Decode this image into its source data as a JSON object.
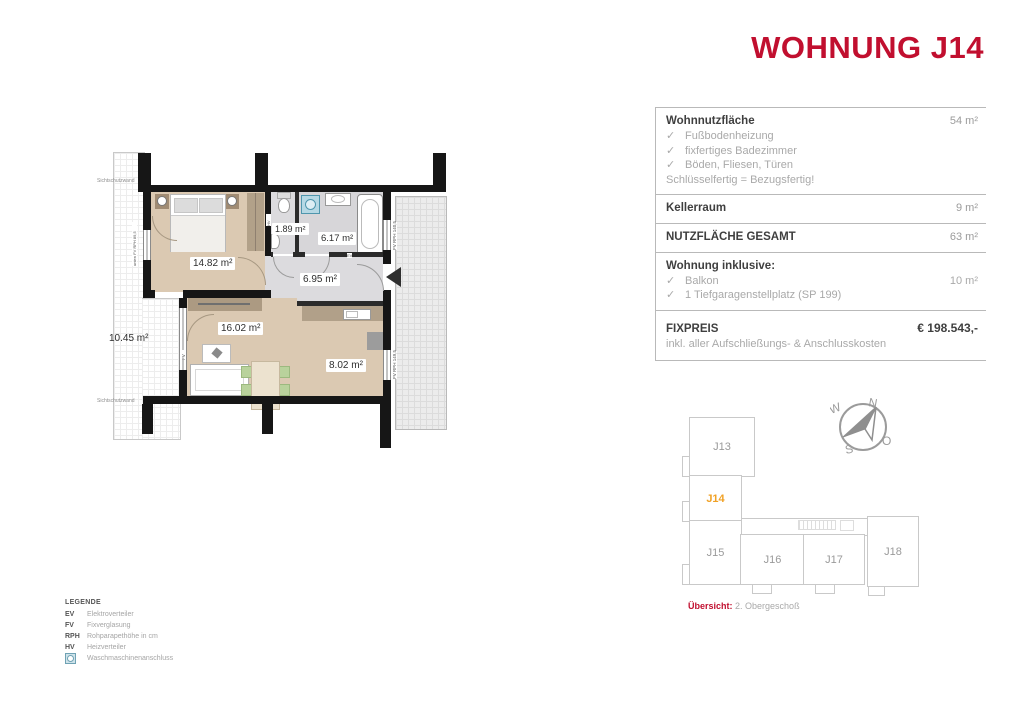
{
  "title": "WOHNUNG J14",
  "info": {
    "check": "✓",
    "wohnnutz_label": "Wohnnutzfläche",
    "wohnnutz_value": "54 m²",
    "wohnnutz_items": [
      "Fußbodenheizung",
      "fixfertiges Badezimmer",
      "Böden, Fliesen, Türen"
    ],
    "wohnnutz_note": "Schlüsselfertig = Bezugsfertig!",
    "keller_label": "Kellerraum",
    "keller_value": "9 m²",
    "gesamt_label": "NUTZFLÄCHE GESAMT",
    "gesamt_value": "63 m²",
    "inklusive_label": "Wohnung inklusive:",
    "inklusive_items": [
      {
        "text": "Balkon",
        "value": "10 m²"
      },
      {
        "text": "1 Tiefgaragenstellplatz (SP 199)",
        "value": ""
      }
    ],
    "fixpreis_label": "FIXPREIS",
    "fixpreis_value": "€ 198.543,-",
    "fixpreis_note": "inkl. aller Aufschließungs- & Anschlusskosten"
  },
  "plan": {
    "rooms": {
      "bedroom": "14.82 m²",
      "wc": "1.89 m²",
      "bath": "6.17 m²",
      "hall": "6.95 m²",
      "living": "16.02 m²",
      "kitchen": "8.02 m²",
      "balcony": "10.45 m²"
    },
    "annotations": {
      "privacy_top": "Sichtschutzwand",
      "privacy_bottom": "Sichtschutzwand",
      "bedroom_window": "unten FV RPH 89,5",
      "hv": "HV",
      "ev": "EV",
      "bath_window": "FV RPH 140,5",
      "kitchen_window": "FV RPH 149,5",
      "living_window": "FV"
    }
  },
  "legend": {
    "title": "LEGENDE",
    "rows": [
      {
        "key": "EV",
        "label": "Elektroverteiler"
      },
      {
        "key": "FV",
        "label": "Fixverglasung"
      },
      {
        "key": "RPH",
        "label": "Rohparapethöhe in cm"
      },
      {
        "key": "HV",
        "label": "Heizverteiler"
      }
    ],
    "wm_label": "Waschmaschinenanschluss"
  },
  "overview": {
    "units": [
      {
        "id": "J13"
      },
      {
        "id": "J14"
      },
      {
        "id": "J15"
      },
      {
        "id": "J16"
      },
      {
        "id": "J17"
      },
      {
        "id": "J18"
      }
    ],
    "highlighted": "J14",
    "caption_label": "Übersicht:",
    "caption_text": "2. Obergeschoß",
    "compass": {
      "n": "N",
      "w": "W",
      "s": "S",
      "o": "O"
    }
  },
  "colors": {
    "accent_red": "#c10f2f",
    "highlight_orange": "#f0a125"
  }
}
